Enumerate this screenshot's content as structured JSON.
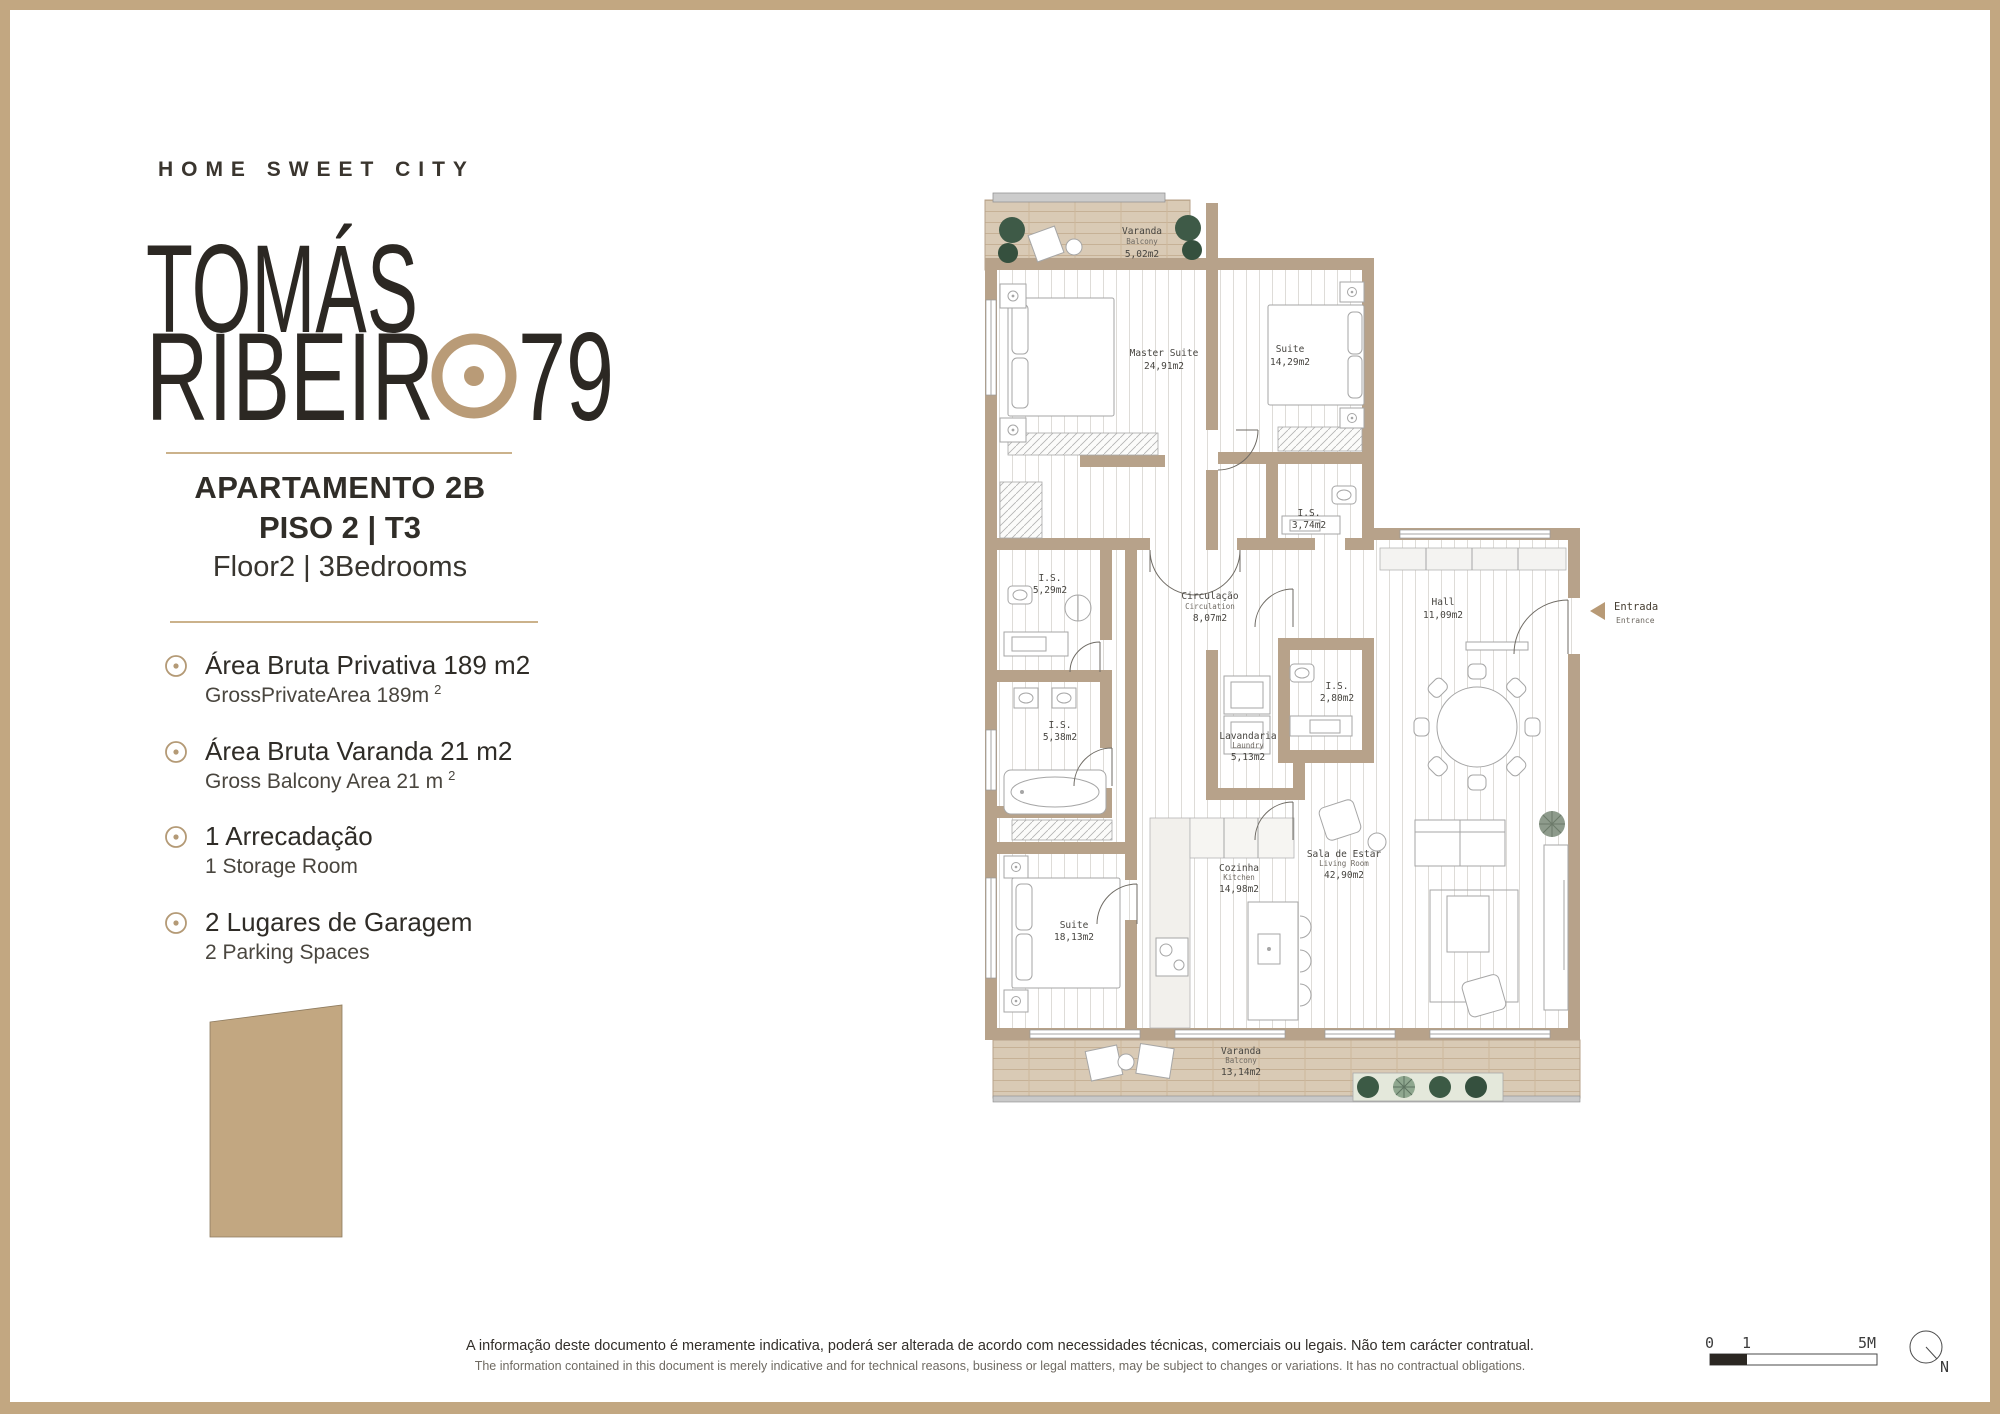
{
  "brand": {
    "tagline": "HOME SWEET CITY",
    "name_line1": "TOMÁS",
    "name_line2": "RIBEIR",
    "name_number": "79"
  },
  "apartment": {
    "title": "APARTAMENTO 2B",
    "floor_pt": "PISO 2 | T3",
    "floor_en": "Floor2 | 3Bedrooms"
  },
  "features": [
    {
      "pt": "Área Bruta Privativa 189 m2",
      "en": "GrossPrivateArea 189m",
      "sup": "2"
    },
    {
      "pt": "Área Bruta Varanda 21 m2",
      "en": "Gross Balcony Area 21 m",
      "sup": "2"
    },
    {
      "pt": "1 Arrecadação",
      "en": "1 Storage Room",
      "sup": ""
    },
    {
      "pt": "2 Lugares de Garagem",
      "en": "2 Parking Spaces",
      "sup": ""
    }
  ],
  "floorplan": {
    "rooms": [
      {
        "name": "Varanda",
        "name_en": "Balcony",
        "area": "5,02m2"
      },
      {
        "name": "Master Suite",
        "name_en": "",
        "area": "24,91m2"
      },
      {
        "name": "Suite",
        "name_en": "",
        "area": "14,29m2"
      },
      {
        "name": "I.S.",
        "name_en": "",
        "area": "3,74m2"
      },
      {
        "name": "I.S.",
        "name_en": "",
        "area": "5,29m2"
      },
      {
        "name": "Circulação",
        "name_en": "Circulation",
        "area": "8,07m2"
      },
      {
        "name": "Hall",
        "name_en": "",
        "area": "11,09m2"
      },
      {
        "name": "I.S.",
        "name_en": "",
        "area": "2,80m2"
      },
      {
        "name": "I.S.",
        "name_en": "",
        "area": "5,38m2"
      },
      {
        "name": "Lavandaria",
        "name_en": "Laundry",
        "area": "5,13m2"
      },
      {
        "name": "Suite",
        "name_en": "",
        "area": "18,13m2"
      },
      {
        "name": "Cozinha",
        "name_en": "Kitchen",
        "area": "14,98m2"
      },
      {
        "name": "Sala de Estar",
        "name_en": "Living Room",
        "area": "42,90m2"
      },
      {
        "name": "Varanda",
        "name_en": "Balcony",
        "area": "13,14m2"
      }
    ],
    "entrance": {
      "pt": "Entrada",
      "en": "Entrance"
    }
  },
  "scale": {
    "t0": "0",
    "t1": "1",
    "t5": "5M",
    "north": "N"
  },
  "footer": {
    "pt": "A informação deste documento é meramente indicativa, poderá ser alterada de acordo com necessidades técnicas, comerciais ou legais. Não tem carácter contratual.",
    "en": "The information contained in this document is merely indicative and for technical reasons, business or legal matters, may be subject to changes or variations. It has no contractual obligations."
  },
  "colors": {
    "accent_tan": "#c2a781",
    "wall_tan": "#b7a28a",
    "deck_tan": "#d9cab5",
    "logo_dark": "#2c2823",
    "bullet_tan": "#b49a76",
    "plant_green": "#3e5a47"
  }
}
